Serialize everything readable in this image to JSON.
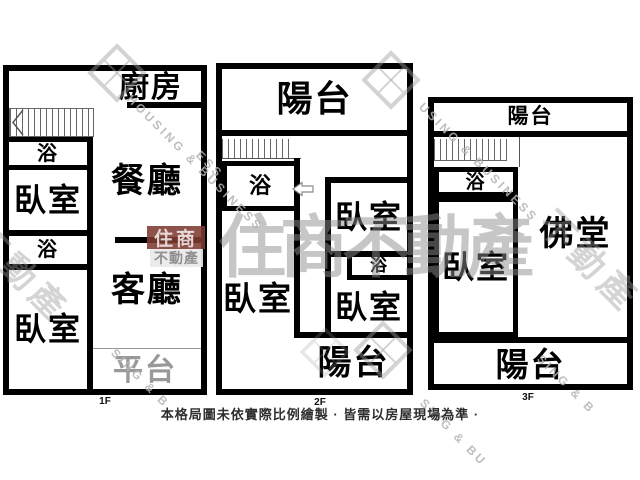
{
  "floors": [
    {
      "name": "1F",
      "rooms": {
        "kitchen": "廚房",
        "dining": "餐廳",
        "bath1": "浴",
        "bedroom1": "臥室",
        "bath2": "浴",
        "bedroom2": "臥室",
        "living": "客廳",
        "platform": "平台"
      }
    },
    {
      "name": "2F",
      "rooms": {
        "balcony_top": "陽台",
        "bath": "浴",
        "bedroom_left": "臥室",
        "bedroom_right_top": "臥室",
        "bath_right": "浴",
        "bedroom_right_bottom": "臥室",
        "balcony_bottom": "陽台"
      }
    },
    {
      "name": "3F",
      "rooms": {
        "balcony_top": "陽台",
        "bath": "浴",
        "bedroom": "臥室",
        "buddhist_hall": "佛堂",
        "balcony_bottom": "陽台"
      }
    }
  ],
  "footer": {
    "disclaimer": "本格局圖未依實際比例繪製 · 皆需以房屋現場為準 ·"
  },
  "watermarks": {
    "badge_primary": "住商",
    "badge_secondary": "不動產",
    "large_brand": "住商不動產",
    "diag_brand": "不動產",
    "diag_en_1": "HOUSING & BUSINESS",
    "diag_en_2": "USING & BUSINESS",
    "diag_en_3": "SING & B",
    "diag_en_4": "SING & B",
    "diag_en_5": "SING & BU",
    "diag_en_6": "ESS",
    "colors": {
      "badge_bg": "#7d3a30",
      "watermark_gray": "#9a9a9a",
      "wall_black": "#000000",
      "platform_gray": "#999999"
    }
  }
}
